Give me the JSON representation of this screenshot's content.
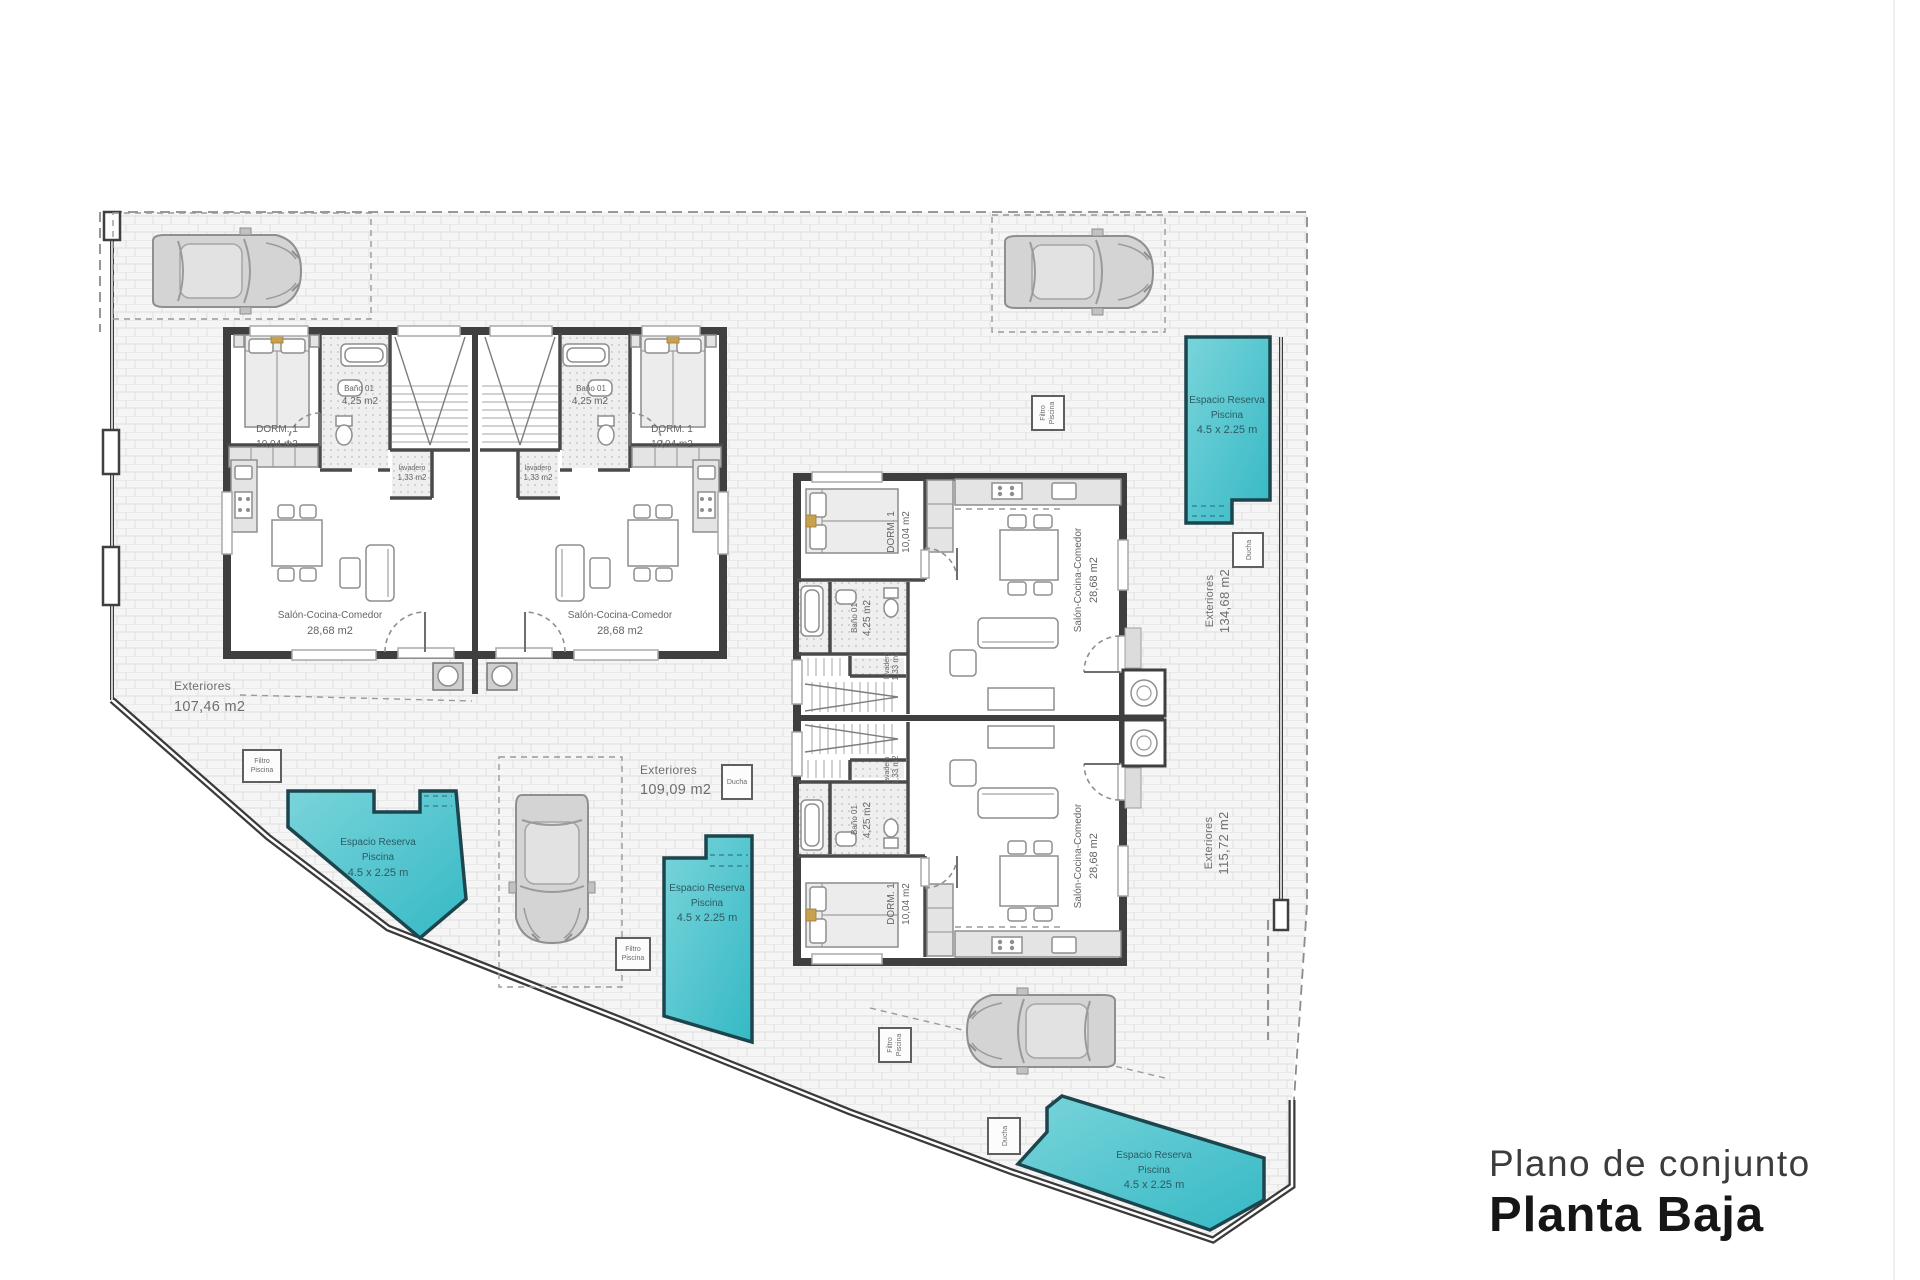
{
  "title_block": {
    "subtitle": "Plano de conjunto",
    "title": "Planta Baja"
  },
  "room_labels": {
    "dorm_name": "DORM. 1",
    "dorm_area": "10,04 m2",
    "bano_name": "Baño 01",
    "bano_area": "4,25 m2",
    "lavadero_name": "lavadero",
    "lavadero_area": "1,33 m2",
    "salon_name": "Salón-Cocina-Comedor",
    "salon_area": "28,68 m2"
  },
  "exteriores": {
    "label": "Exteriores",
    "left_area": "107,46 m2",
    "center_area": "109,09 m2",
    "right_top_area": "134,68 m2",
    "right_bottom_area": "115,72 m2"
  },
  "pool_label": {
    "line1": "Espacio Reserva",
    "line2": "Piscina",
    "line3": "4.5 x 2.25 m"
  },
  "equipment": {
    "filtro_line1": "Filtro",
    "filtro_line2": "Piscina",
    "ducha": "Ducha"
  },
  "colors": {
    "pool_fill_light": "#7ad4da",
    "pool_fill_dark": "#35b9c5",
    "pool_edge": "#1d454e",
    "pool_text": "#2d5a63",
    "wall": "#3f3f3f",
    "brick_bg": "#f5f5f5",
    "brick_line": "#e2e2e2"
  }
}
